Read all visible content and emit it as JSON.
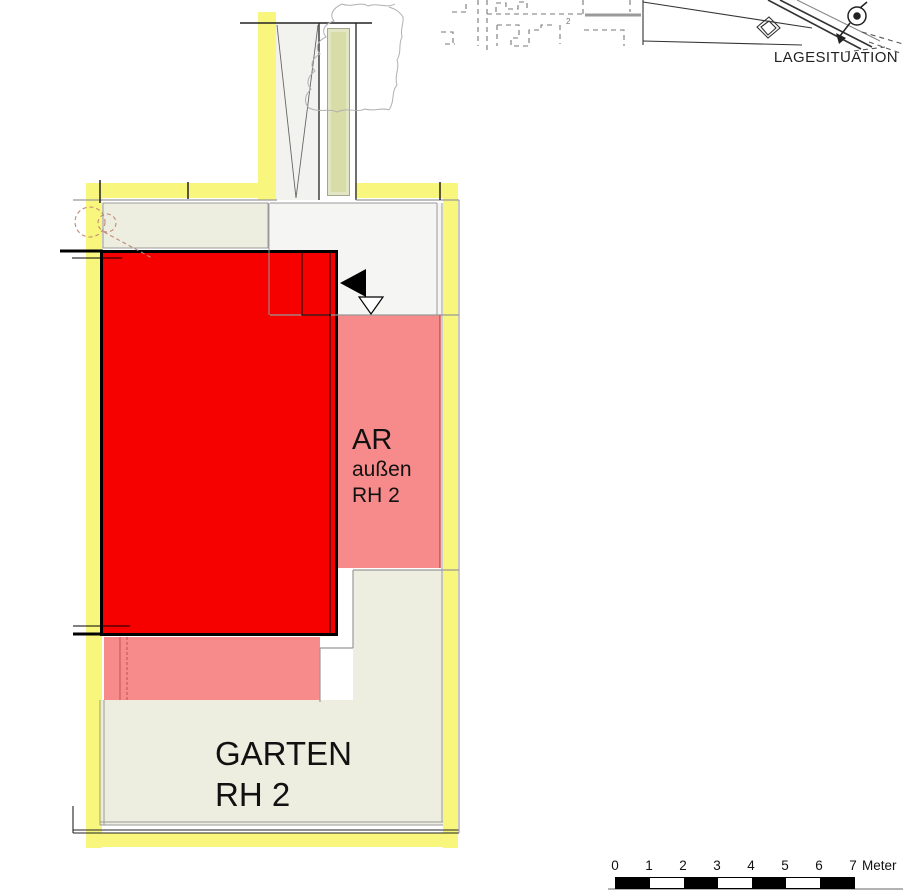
{
  "site_map": {
    "title": "LAGESITUATION",
    "marker_label": "2"
  },
  "plan": {
    "ar_area": {
      "label_main": "AR",
      "label_sub1": "außen",
      "label_sub2": "RH 2"
    },
    "garten_area": {
      "label_line1": "GARTEN",
      "label_line2": "RH 2"
    }
  },
  "scale_bar": {
    "tick_labels": [
      "0",
      "1",
      "2",
      "3",
      "4",
      "5",
      "6",
      "7"
    ],
    "unit_label": "Meter",
    "segments": 7,
    "meters_total": 7
  },
  "colors": {
    "highlight_yellow": "#F8F67D",
    "building_red": "#F70000",
    "ar_pink": "#F78B8B",
    "garten_beige": "#EDEEDF",
    "hedge_green": "#E3E6C3",
    "hedge_core_green": "#D8DDA8",
    "driveway_gray": "#F2F2EF",
    "forecourt_gray": "#F5F5F3",
    "line_gray": "#999999",
    "pink_edge_red": "#C9534F",
    "tree_dashed_brown": "#C08878"
  }
}
